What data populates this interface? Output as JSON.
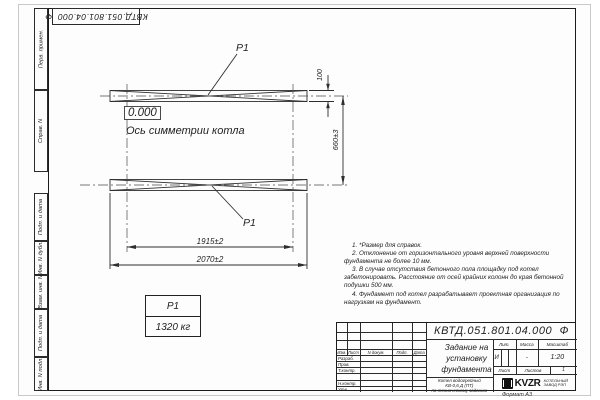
{
  "sheet": {
    "stamp_designation_rotated": "КВТД.051.801.04.000  Ф",
    "format_label": "Формат А3",
    "margin_labels": {
      "perv_primen": "Перв. примен.",
      "sprav_n": "Справ. N",
      "podp_data_1": "Подп. и дата",
      "inv_dubl": "Инв. N дубл.",
      "vzam_inv": "Взам. инв. N",
      "podp_data_2": "Подп. и дата",
      "inv_podl": "Инв. N подл."
    }
  },
  "drawing": {
    "support_label_top": "Р1",
    "support_label_bottom": "Р1",
    "elevation_mark": "0.000",
    "axis_caption": "Ось симметрии котла",
    "dims": {
      "beam_height": "100",
      "beams_spacing": "660±3",
      "columns_span": "1915±2",
      "beam_length": "2070±2"
    }
  },
  "load_table": {
    "header": "Р1",
    "value": "1320 кг"
  },
  "notes": [
    "1. *Размер для справок.",
    "2. Отклонение от горизонтального уровня верхней поверхности фундамента не более 10 мм.",
    "3. В случае отсутствия бетонного пола площадку под котел забетонировать. Расстояние от осей крайних колонн до края бетонной подушки 500 мм.",
    "4. Фундамент под котел разрабатывает проектная организация по нагрузкам на фундамент."
  ],
  "title_block": {
    "designation": "КВТД.051.801.04.000  Ф",
    "doc_title": "Задание на установку фундамента",
    "product_line1": "Котел водогрейный",
    "product_line2": "КВ-0,6 Д (ПТ)",
    "product_line3": "по техническому заданию",
    "col_izm": "Изм.",
    "col_list": "Лист",
    "col_ndoc": "N докум.",
    "col_podp": "Подп.",
    "col_data": "Дата",
    "row_razrab": "Разраб.",
    "row_prov": "Пров.",
    "row_tkontr": "Т.контр.",
    "row_nkontr": "Н.контр.",
    "row_utv": "Утв.",
    "lit_label": "Лит.",
    "mass_label": "Масса",
    "scale_label": "Масштаб",
    "lit_value": "И",
    "mass_value": "-",
    "scale_value": "1:20",
    "list_label": "Лист",
    "listov_label": "Листов",
    "listov_value": "1",
    "logo_text": "KVZR",
    "company_line1": "КОТЕЛЬНЫЙ",
    "company_line2": "ЗАВОД РЭП"
  }
}
